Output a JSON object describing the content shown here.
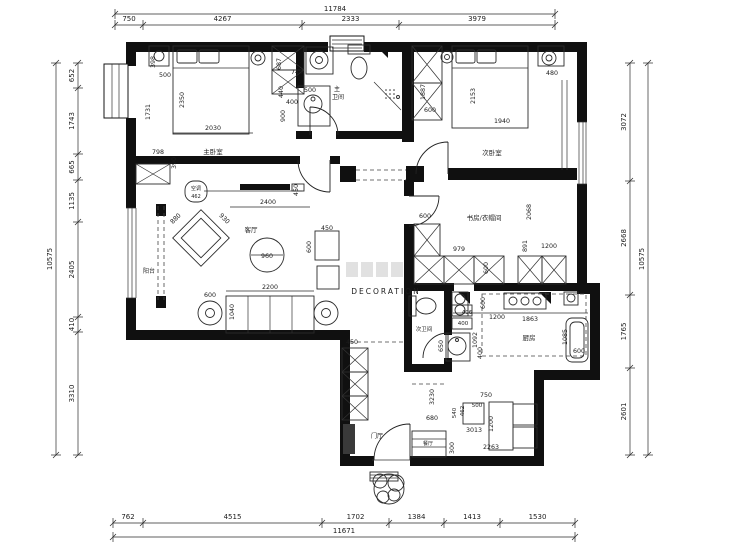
{
  "watermark": {
    "brand": "DECORATION"
  },
  "dim_top": {
    "total": "11784",
    "segs": [
      "750",
      "4267",
      "2333",
      "3979"
    ]
  },
  "dim_bottom": {
    "total": "11671",
    "segs": [
      "762",
      "4515",
      "1702",
      "1384",
      "1413",
      "1530"
    ]
  },
  "dim_left": {
    "total": "10575",
    "segs": [
      "652",
      "1743",
      "665",
      "1135",
      "2405",
      "410",
      "3310"
    ]
  },
  "dim_right": {
    "total": "10575",
    "segs": [
      "3072",
      "2668",
      "1765",
      "2601"
    ]
  },
  "rooms": {
    "master_bedroom": "主卧室",
    "master_bath_l1": "主",
    "master_bath_l2": "卫间",
    "second_bedroom": "次卧室",
    "study": "书房/衣帽间",
    "living": "客厅",
    "balcony": "阳台",
    "second_bath": "次卫间",
    "kitchen": "厨房",
    "dining": "餐厅",
    "foyer": "门厅",
    "ac_label": "空调",
    "ac_size": "462"
  },
  "fdims": {
    "master": [
      "398",
      "500",
      "1731",
      "2350",
      "2030",
      "798",
      "390",
      "687",
      "746",
      "440",
      "400",
      "900",
      "500"
    ],
    "second": [
      "1887",
      "600",
      "2153",
      "1940",
      "480"
    ],
    "study": [
      "600",
      "979",
      "600",
      "2068",
      "891",
      "1200"
    ],
    "living": [
      "880",
      "930",
      "2400",
      "450",
      "960",
      "450",
      "600",
      "2200",
      "600",
      "1040"
    ],
    "bath2": [
      "406",
      "400",
      "650"
    ],
    "kitchen": [
      "600",
      "1200",
      "1863",
      "1092",
      "400",
      "1085",
      "600"
    ],
    "foyer": [
      "450",
      "3230",
      "680",
      "750",
      "540",
      "462",
      "500",
      "1200",
      "3013",
      "2263",
      "300"
    ]
  }
}
